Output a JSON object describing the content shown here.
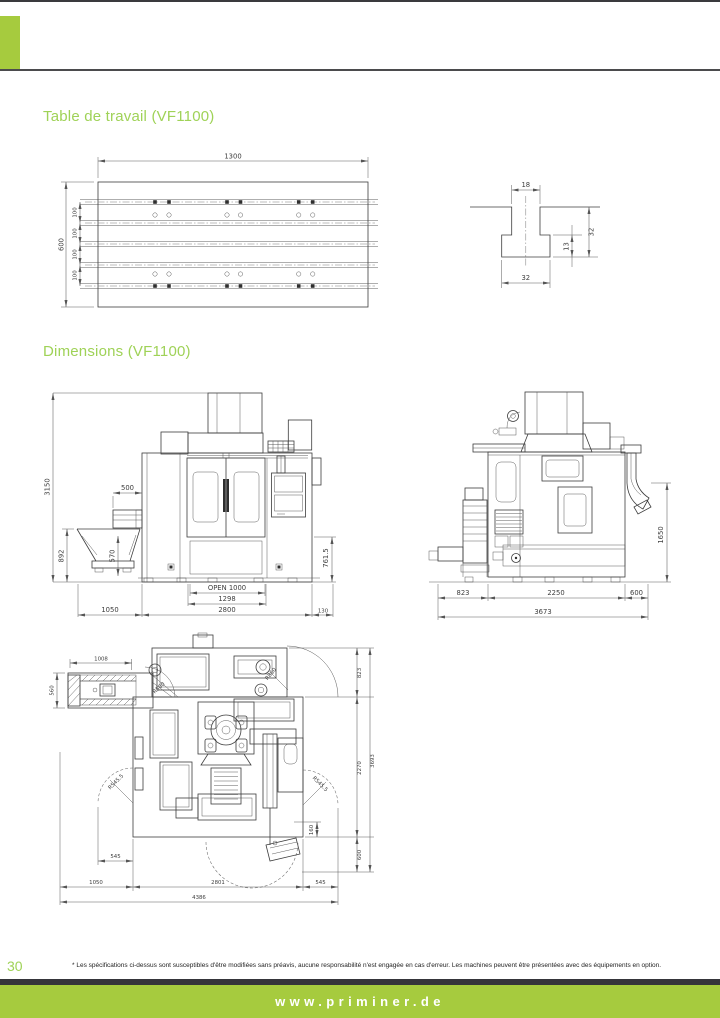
{
  "colors": {
    "accent_green": "#a6cb3e",
    "heading_green": "#9fd257",
    "rule_dark": "#3a3a3e"
  },
  "sections": {
    "table_title": "Table de travail (VF1100)",
    "dims_title": "Dimensions (VF1100)"
  },
  "footer": {
    "page_number": "30",
    "disclaimer": "* Les spécifications ci-dessus sont susceptibles d'être modifiées sans préavis, aucune responsabilité n'est engagée en cas d'erreur. Les machines peuvent être présentées avec des équipements en option.",
    "website": "www.priminer.de"
  },
  "table": {
    "w": "1300",
    "h": "600",
    "s": "100"
  },
  "tslot": {
    "top": "18",
    "depth": "32",
    "lip": "13",
    "bottom": "32"
  },
  "front": {
    "h": "3150",
    "conv": "500",
    "hop": "892",
    "hop2": "570",
    "tab": "761.5",
    "open": "OPEN 1000",
    "d1298": "1298",
    "d2800": "2800",
    "d1050": "1050",
    "d130": "130"
  },
  "side": {
    "a": "823",
    "b": "2250",
    "c": "600",
    "tot": "3673",
    "e": "1650"
  },
  "top": {
    "conv": "1008",
    "convw": "560",
    "a": "823",
    "b": "2270",
    "tot": "3693",
    "p160": "160",
    "c": "600",
    "doorl": "545",
    "l1050": "1050",
    "w2801": "2801",
    "doorr": "545",
    "tot2": "4386",
    "rl": "R545.5",
    "rr": "R545.5",
    "r500": "R500",
    "r850": "R850"
  }
}
